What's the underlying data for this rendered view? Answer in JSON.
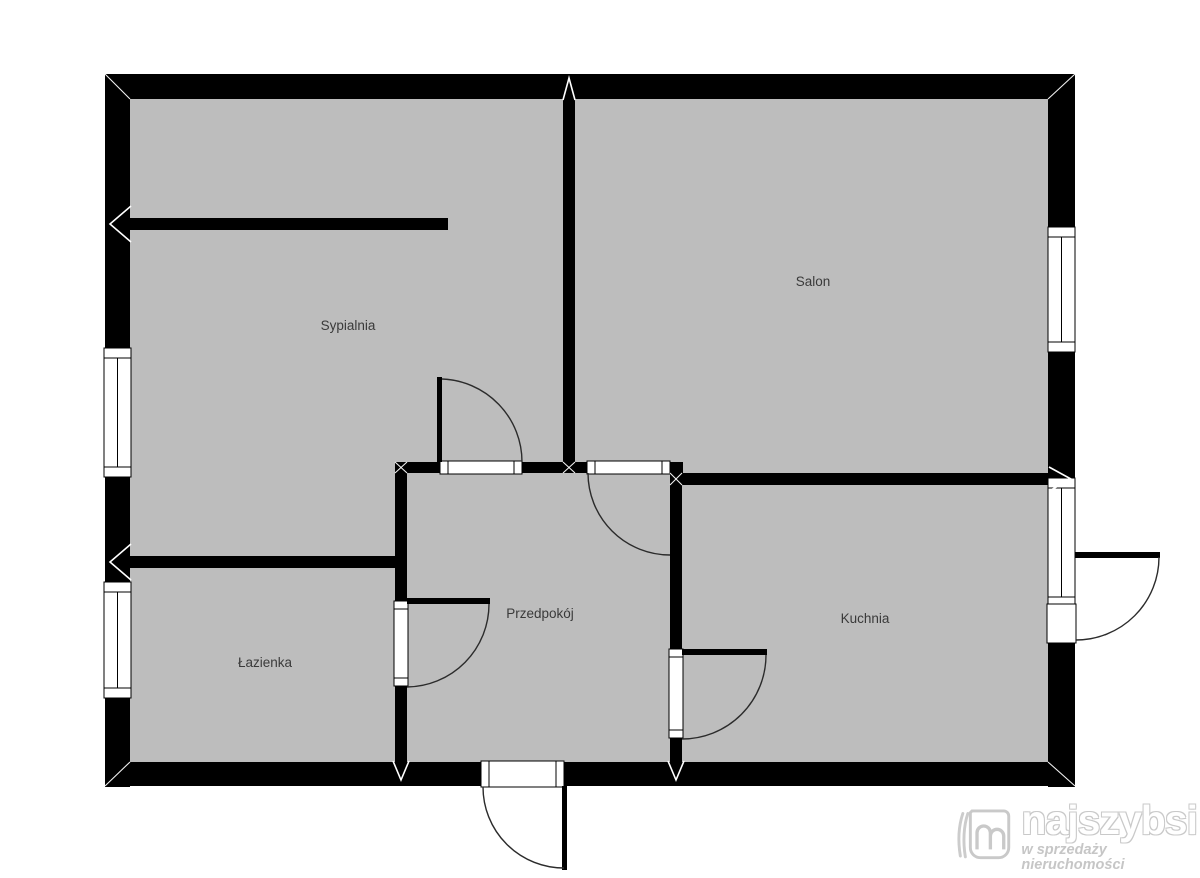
{
  "meta": {
    "background": "#ffffff",
    "wall_color": "#000000",
    "floor_color": "#bdbdbd",
    "door_arc_color": "#2b2b2b",
    "label_color": "#3a3a3a",
    "logo_color": "#c9c9c9"
  },
  "rooms": {
    "bedroom": {
      "label": "Sypialnia"
    },
    "living": {
      "label": "Salon"
    },
    "bathroom": {
      "label": "Łazienka"
    },
    "hall": {
      "label": "Przedpokój"
    },
    "kitchen": {
      "label": "Kuchnia"
    }
  },
  "logo": {
    "brand": "najszybsi",
    "tagline": "w sprzedaży nieruchomości",
    "icon": "book-m-icon"
  }
}
